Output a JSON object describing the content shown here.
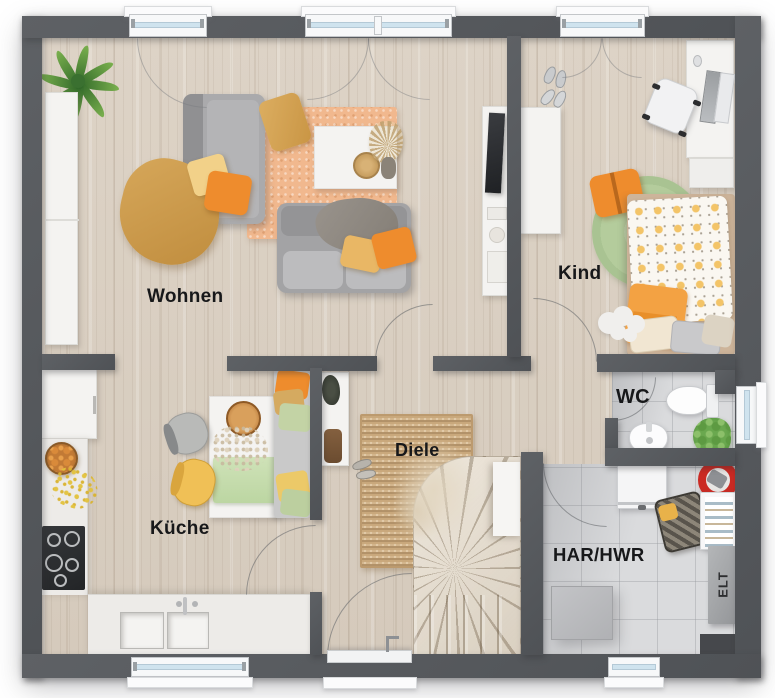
{
  "rooms": {
    "wohnen": {
      "label": "Wohnen"
    },
    "kind": {
      "label": "Kind"
    },
    "kueche": {
      "label": "Küche"
    },
    "diele": {
      "label": "Diele"
    },
    "wc": {
      "label": "WC"
    },
    "har_hwr": {
      "label": "HAR/HWR"
    },
    "elt": {
      "label": "ELT"
    }
  },
  "colors": {
    "wall": "#55585c",
    "wood_floor": "#d9cfc1",
    "tile_floor": "#dadbdd",
    "jute_rug": "#c9a87c",
    "peach_rug": "#f1b88e",
    "green_rug": "#b9d0a2",
    "accent_orange": "#ee8c2d",
    "accent_yellow": "#e9b765",
    "sofa_gray": "#a3a3a5",
    "window_glass": "#cfe3ee",
    "elt_panel": "#a6a8ab"
  }
}
